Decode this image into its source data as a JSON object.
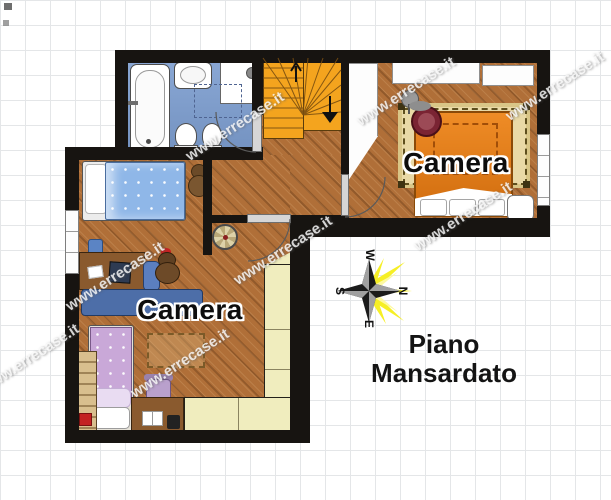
{
  "floorplan": {
    "watermark": "www.errecase.it",
    "title_line1": "Piano",
    "title_line2": "Mansardato",
    "rooms": {
      "bedroom_right": {
        "label": "Camera"
      },
      "bedroom_left": {
        "label": "Camera"
      }
    },
    "compass": {
      "n": "N",
      "e": "E",
      "s": "S",
      "w": "W"
    },
    "colors": {
      "wall": "#171411",
      "wood_floor": "#b06f38",
      "bathroom_floor": "#7d9ed0",
      "stairs_orange": "#f4a41e",
      "wardrobe_cream": "#f0edbe",
      "bed_orange": "#e07a16",
      "rug_beige": "#e9d9a6",
      "bed_blue": "#8fb7e8",
      "bed_purple": "#c9a8d8",
      "sofa_blue": "#4d6ea8",
      "desk_wood": "#8a5a2e",
      "compass_yellow": "#f6ef25",
      "armchair_red": "#7a2433"
    }
  }
}
